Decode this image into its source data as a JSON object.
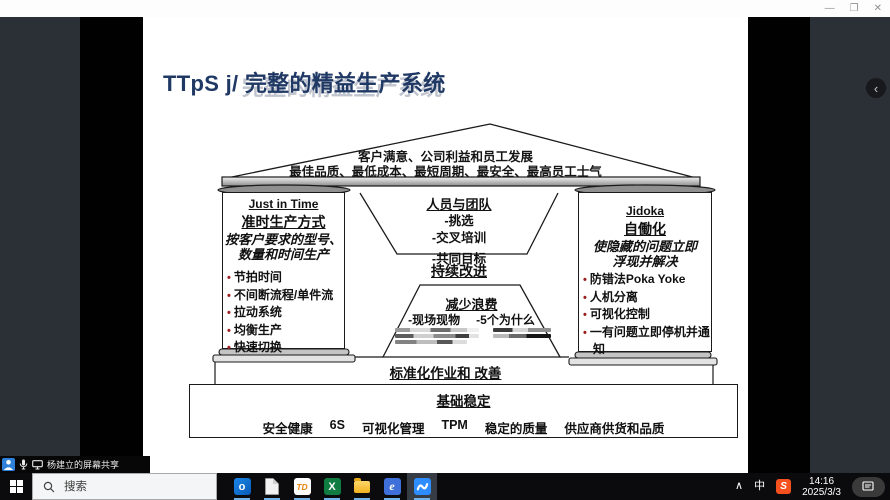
{
  "colors": {
    "title_navy": "#1f3864",
    "bullet_red": "#9c1f1f",
    "meeting_blue": "#2d8cff",
    "taskbar_bg": "#0b0b0d",
    "side_panel_gray": "#2b2f36"
  },
  "window": {
    "minimize": "—",
    "maximize": "❐",
    "close": "✕",
    "panel_chevron": "‹"
  },
  "slide": {
    "title_prefix": "TTpS j/",
    "title_main": "完整的精益生产系统",
    "roof_line1": "客户满意、公司利益和员工发展",
    "roof_line2": "最佳品质、最低成本、最短周期、最安全、最高员工士气",
    "jit": {
      "en": "Just in Time",
      "cn": "准时生产方式",
      "desc1": "按客户要求的型号、",
      "desc2": "数量和时间生产",
      "bullets": [
        "节拍时间",
        "不间断流程/单件流",
        "拉动系统",
        "均衡生产",
        "快速切换"
      ]
    },
    "jidoka": {
      "en": "Jidoka",
      "cn": "自働化",
      "desc1": "使隐藏的问题立即",
      "desc2": "浮现并解决",
      "bullets": [
        "防错法Poka Yoke",
        "人机分离",
        "可视化控制",
        "一有问题立即停机并通知"
      ]
    },
    "team": {
      "title": "人员与团队",
      "items": [
        "-挑选",
        "-交叉培训",
        "-共同目标"
      ]
    },
    "kaizen": "持续改进",
    "waste": {
      "title": "减少浪费",
      "left": "-现场现物",
      "right": "-5个为什么"
    },
    "standard": "标准化作业和 改善",
    "foundation": {
      "title": "基础稳定",
      "items": [
        "安全健康",
        "6S",
        "可视化管理",
        "TPM",
        "稳定的质量",
        "供应商供货和品质"
      ]
    }
  },
  "share_bar": {
    "label": "杨建立的屏幕共享"
  },
  "taskbar": {
    "search_placeholder": "搜索",
    "icons": {
      "outlook": "o",
      "td": "TD",
      "excel": "X",
      "e_app": "e",
      "sogou": "S"
    },
    "tray_chevron": "∧",
    "ime": "中",
    "time": "14:16",
    "date": "2025/3/3"
  }
}
